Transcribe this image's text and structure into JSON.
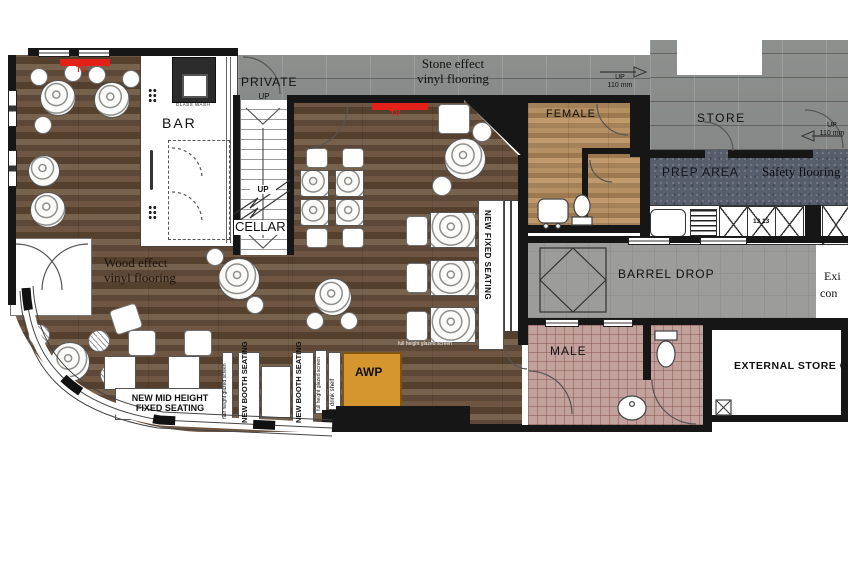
{
  "labels": {
    "stone1": "Stone effect",
    "stone2": "vinyl flooring",
    "wood1": "Wood effect",
    "wood2": "vinyl flooring",
    "private": "PRIVATE",
    "up": "UP",
    "bar": "BAR",
    "glass_wash": "GLASS WASH",
    "cellar": "CELLAR",
    "tv": "TV",
    "female": "FEMALE",
    "male": "MALE",
    "store": "STORE",
    "up110a": "UP",
    "up110b": "110 mm",
    "prep": "PREP AREA",
    "safety": "Safety flooring",
    "barrel": "BARREL DROP",
    "exi1": "Exi",
    "exi2": "con",
    "external": "EXTERNAL STORE OI",
    "awp": "AWP",
    "fixed_seating": "NEW FIXED SEATING",
    "mid1": "NEW MID HEIGHT",
    "mid2": "FIXED SEATING",
    "booth": "NEW BOOTH SEATING",
    "half_screen": "half height glazed screen",
    "full_screen": "full height glazed screen",
    "drink_shelf": "drink shelf",
    "unit": "13 13"
  },
  "colors": {
    "wood": "#6a5240",
    "wood_light": "#b18a5f",
    "stone": "#8c8f8c",
    "safety_floor": "#565e6c",
    "corridor": "#9c9c9a",
    "male_tile": "#c3a19d",
    "awp_orange": "#d6962f",
    "tv_red": "#e32119",
    "wall": "#161616"
  }
}
